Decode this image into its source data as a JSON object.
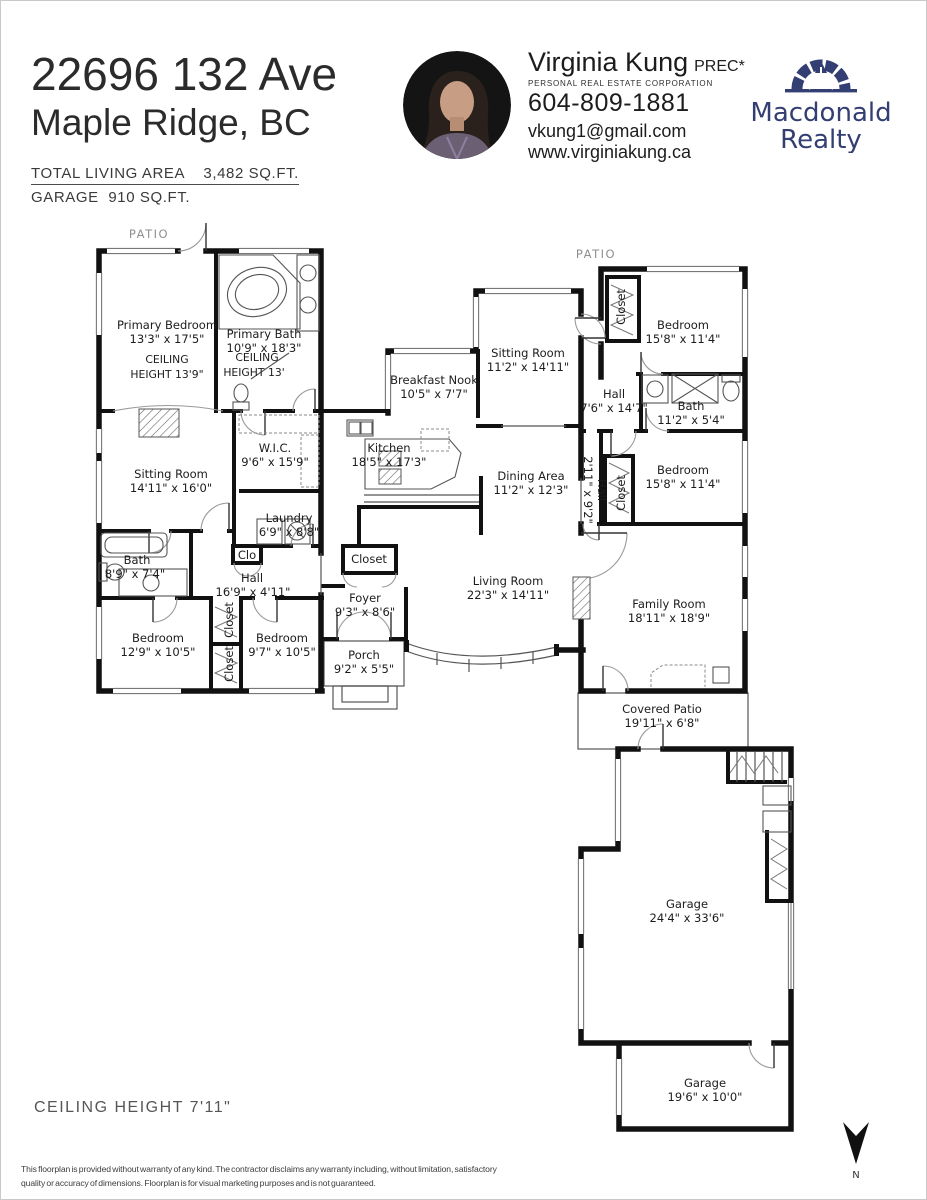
{
  "header": {
    "address_line1": "22696 132 Ave",
    "address_line2": "Maple Ridge, BC",
    "total_area": "TOTAL LIVING AREA    3,482 SQ.FT.",
    "garage_area": "GARAGE  910 SQ.FT.",
    "agent": {
      "name": "Virginia Kung",
      "designation": "PREC*",
      "subtitle": "PERSONAL REAL ESTATE CORPORATION",
      "phone": "604-809-1881",
      "email": "vkung1@gmail.com",
      "website": "www.virginiakung.ca"
    },
    "brokerage": {
      "line1": "Macdonald",
      "line2": "Realty",
      "color": "#333e72"
    }
  },
  "plan": {
    "patio_left": "PATIO",
    "patio_right": "PATIO",
    "rooms": [
      {
        "name": "Primary Bedroom",
        "dims": "13'3\" x 17'5\""
      },
      {
        "name": "Primary Bath",
        "dims": "10'9\" x 18'3\""
      },
      {
        "name": "Sitting Room",
        "dims": "11'2\" x 14'11\""
      },
      {
        "name": "Breakfast Nook",
        "dims": "10'5\" x 7'7\""
      },
      {
        "name": "Bedroom",
        "dims": "15'8\" x 11'4\""
      },
      {
        "name": "Hall",
        "dims": "7'6\" x 14'7\""
      },
      {
        "name": "Bath",
        "dims": "11'2\" x 5'4\""
      },
      {
        "name": "W.I.C.",
        "dims": "9'6\" x 15'9\""
      },
      {
        "name": "Kitchen",
        "dims": "18'5\" x 17'3\""
      },
      {
        "name": "Sitting Room",
        "dims": "14'11\" x 16'0\""
      },
      {
        "name": "Bedroom",
        "dims": "15'8\" x 11'4\""
      },
      {
        "name": "Dining Area",
        "dims": "11'2\" x 12'3\""
      },
      {
        "name": "Laundry",
        "dims": "6'9\" x 8'8\""
      },
      {
        "name": "Bath",
        "dims": "8'9\" x 7'4\""
      },
      {
        "name": "Hall",
        "dims": "16'9\" x 4'11\""
      },
      {
        "name": "Living Room",
        "dims": "22'3\" x 14'11\""
      },
      {
        "name": "Foyer",
        "dims": "9'3\" x 8'6\""
      },
      {
        "name": "Family Room",
        "dims": "18'11\" x 18'9\""
      },
      {
        "name": "Bedroom",
        "dims": "12'9\" x 10'5\""
      },
      {
        "name": "Bedroom",
        "dims": "9'7\" x 10'5\""
      },
      {
        "name": "Porch",
        "dims": "9'2\" x 5'5\""
      },
      {
        "name": "Covered Patio",
        "dims": "19'11\" x 6'8\""
      },
      {
        "name": "Garage",
        "dims": "24'4\" x 33'6\""
      },
      {
        "name": "Garage",
        "dims": "19'6\" x 10'0\""
      }
    ],
    "ceiling_notes": [
      {
        "line1": "CEILING",
        "line2": "HEIGHT 13'9\""
      },
      {
        "line1": "CEILING",
        "line2": "HEIGHT 13'"
      }
    ],
    "vlabels": [
      {
        "text": "Closet"
      },
      {
        "text": "Closet"
      },
      {
        "text": "Closet"
      },
      {
        "text": "Closet"
      },
      {
        "text": "Hall"
      },
      {
        "text": "2'11\" x 9'2\""
      }
    ],
    "small_labels": [
      {
        "text": "Clo"
      },
      {
        "text": "Closet"
      }
    ]
  },
  "footer": {
    "ceiling_note": "CEILING HEIGHT 7'11\"",
    "disclaimer_line1": "This floorplan is provided without warranty of any kind. The contractor disclaims any warranty including, without limitation, satisfactory",
    "disclaimer_line2": "quality or accuracy of dimensions. Floorplan is for visual marketing purposes and is not guaranteed.",
    "north": "N"
  }
}
